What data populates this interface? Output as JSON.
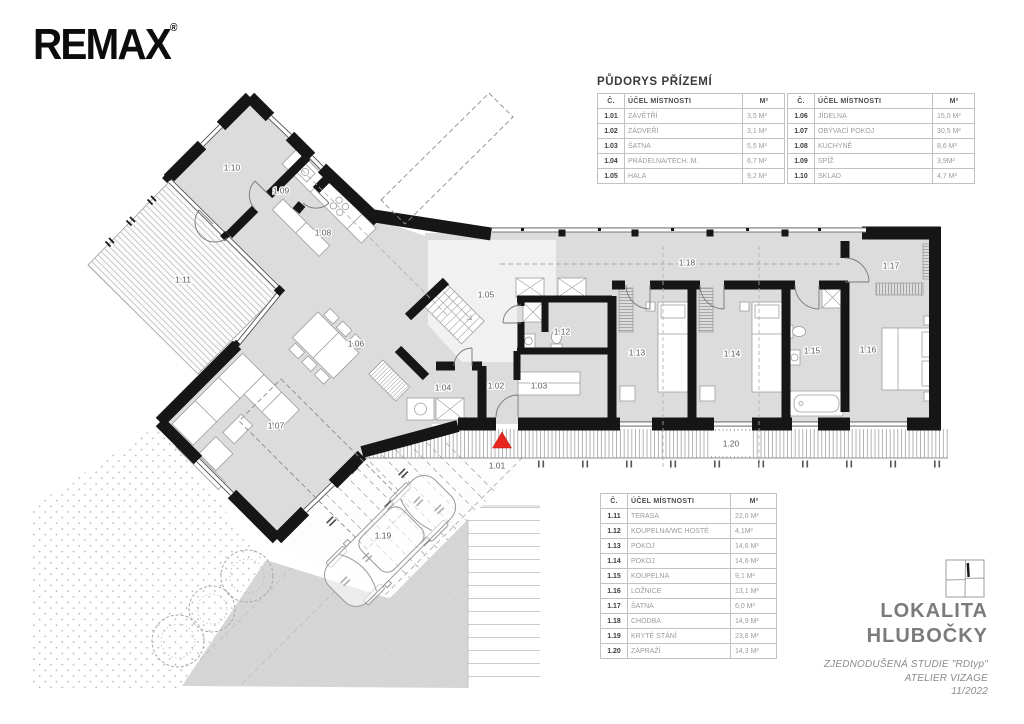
{
  "sheet": {
    "brand": {
      "name": "REMAX",
      "registered": "®"
    },
    "legend": {
      "title": "PŮDORYS PŘÍZEMÍ",
      "columns": [
        "Č.",
        "ÚČEL MÍSTNOSTI",
        "M²"
      ],
      "tables": [
        {
          "rows": [
            [
              "1.01",
              "ZÁVĚTŘÍ",
              "3,5 M²"
            ],
            [
              "1.02",
              "ZÁDVEŘÍ",
              "3,1 M²"
            ],
            [
              "1.03",
              "ŠATNA",
              "5,5 M²"
            ],
            [
              "1.04",
              "PRÁDELNA/TECH. M.",
              "6,7 M²"
            ],
            [
              "1.05",
              "HALA",
              "9,2 M²"
            ]
          ]
        },
        {
          "rows": [
            [
              "1.06",
              "JÍDELNA",
              "15,0 M²"
            ],
            [
              "1.07",
              "OBÝVACÍ POKOJ",
              "30,5 M²"
            ],
            [
              "1.08",
              "KUCHYNĚ",
              "8,6 M²"
            ],
            [
              "1.09",
              "SPÍŽ",
              "3,9M²"
            ],
            [
              "1.10",
              "SKLAD",
              "4,7 M²"
            ]
          ]
        },
        {
          "rows": [
            [
              "1.11",
              "TERASA",
              "22,0 M²"
            ],
            [
              "1.12",
              "KOUPELNA/WC HOSTÉ",
              "4,1M²"
            ],
            [
              "1.13",
              "POKOJ",
              "14,6 M²"
            ],
            [
              "1.14",
              "POKOJ",
              "14,6 M²"
            ],
            [
              "1.15",
              "KOUPELNA",
              "9,1 M²"
            ],
            [
              "1.16",
              "LOŽNICE",
              "13,1 M²"
            ],
            [
              "1.17",
              "ŠATNA",
              "6,0 M²"
            ],
            [
              "1.18",
              "CHODBA",
              "14,9 M²"
            ],
            [
              "1.19",
              "KRYTÉ STÁNÍ",
              "23,8 M²"
            ],
            [
              "1.20",
              "ZÁPRAŽÍ",
              "14,3 M²"
            ]
          ]
        }
      ]
    },
    "plan": {
      "room_labels": [
        "1.01",
        "1.02",
        "1.03",
        "1.04",
        "1.05",
        "1.06",
        "1.07",
        "1.08",
        "1.09",
        "1.10",
        "1.11",
        "1.12",
        "1.13",
        "1.14",
        "1.15",
        "1.16",
        "1.17",
        "1.18",
        "1.19",
        "1.20"
      ],
      "entrance_marker": "red-triangle",
      "accent_color": "#e8251f"
    },
    "title_block": {
      "locality_label": "LOKALITA",
      "locality_name": "HLUBOČKY",
      "study": "ZJEDNODUŠENÁ STUDIE \"RDtyp\"",
      "studio": "ATELIER VIZAGE",
      "date": "11/2022"
    }
  }
}
